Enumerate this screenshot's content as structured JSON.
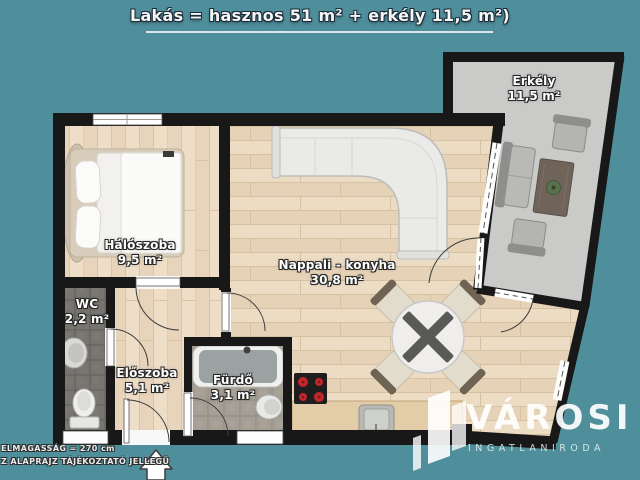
{
  "title": {
    "text": "Lakás = hasznos 51 m² + erkély 11,5 m²)"
  },
  "rooms": {
    "haloszoba": {
      "name": "Hálószoba",
      "area": "9,5 m²"
    },
    "wc": {
      "name": "WC",
      "area": "2,2 m²"
    },
    "eloszoba": {
      "name": "Előszoba",
      "area": "5,1 m²"
    },
    "furdo": {
      "name": "Fürdő",
      "area": "3,1 m²"
    },
    "nappali": {
      "name": "Nappali - konyha",
      "area": "30,8 m²"
    },
    "erkely": {
      "name": "Erkély",
      "area": "11,5 m²"
    }
  },
  "notes": {
    "line1": "ELMAGASSÁG = 270 cm",
    "line2": "Z ALAPRAJZ TÁJÉKOZTATÓ JELLEGŰ"
  },
  "logo": {
    "brand": "VÁROSI",
    "subtitle": "INGATLANIRODA"
  },
  "colors": {
    "background": "#4f8f9b",
    "wall": "#181818",
    "wood_floor": "#ead9c1",
    "balcony_floor": "#cacac8",
    "wc_tile": "#787570",
    "bath_tile": "#a59e95",
    "burner_red": "#c3272b",
    "label_text": "#ffffff"
  }
}
